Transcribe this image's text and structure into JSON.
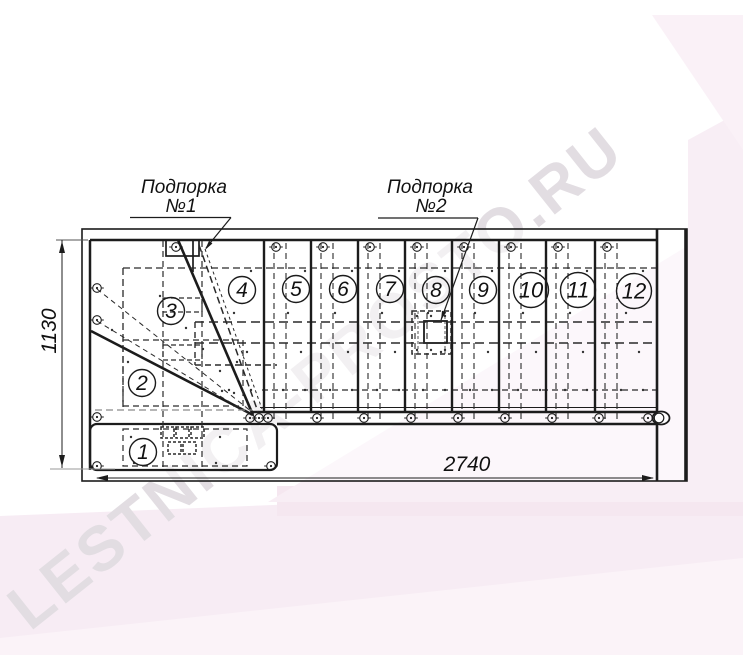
{
  "watermark": {
    "text": "LESTNICA-PROSTO.RU",
    "color": "#e2dde2"
  },
  "supports": [
    {
      "label_line1": "Подпорка",
      "label_line2": "№1"
    },
    {
      "label_line1": "Подпорка",
      "label_line2": "№2"
    }
  ],
  "dimensions": {
    "horizontal": "2740",
    "vertical": "1130"
  },
  "steps": [
    {
      "n": "1",
      "cx": 143,
      "cy": 452,
      "r": 13.5,
      "fs": 21
    },
    {
      "n": "2",
      "cx": 142,
      "cy": 383,
      "r": 13.5,
      "fs": 21
    },
    {
      "n": "3",
      "cx": 171,
      "cy": 311,
      "r": 13.5,
      "fs": 21
    },
    {
      "n": "4",
      "cx": 242,
      "cy": 290,
      "r": 13.5,
      "fs": 21
    },
    {
      "n": "5",
      "cx": 296,
      "cy": 289,
      "r": 13.5,
      "fs": 21
    },
    {
      "n": "6",
      "cx": 343,
      "cy": 289,
      "r": 13.5,
      "fs": 21
    },
    {
      "n": "7",
      "cx": 390,
      "cy": 289,
      "r": 13.5,
      "fs": 21
    },
    {
      "n": "8",
      "cx": 436,
      "cy": 290,
      "r": 13.5,
      "fs": 21
    },
    {
      "n": "9",
      "cx": 483,
      "cy": 290,
      "r": 13.5,
      "fs": 21
    },
    {
      "n": "10",
      "cx": 531,
      "cy": 290,
      "r": 17.5,
      "fs": 22
    },
    {
      "n": "11",
      "cx": 578,
      "cy": 290,
      "r": 17.5,
      "fs": 22
    },
    {
      "n": "12",
      "cx": 634,
      "cy": 291,
      "r": 17.5,
      "fs": 22
    }
  ],
  "colors": {
    "line": "#1c1c1c",
    "dash": "#2a2a2a",
    "gray_dash": "#8a8a8a",
    "watermark": "#e2dde2",
    "pink_main": "#f7ecf4",
    "pink_wedge": "#f8eef5",
    "pink_band": "#f8eef5",
    "pink_corner": "#faf1f7",
    "pink_bottom": "#fbf3f8",
    "pink_deep": "#f5e7f0"
  }
}
